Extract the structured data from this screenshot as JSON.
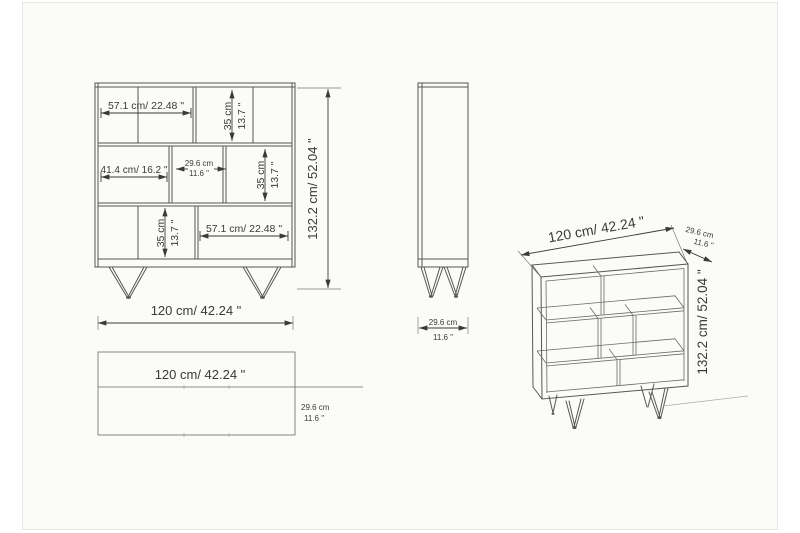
{
  "image": {
    "type": "furniture-technical-drawing",
    "colors": {
      "line": "#565656",
      "text": "#3a3a3a",
      "canvas": "#fbfbf8",
      "canvas_border": "#e8e8e2"
    }
  },
  "front_view": {
    "top": {
      "width": "57.1 cm/ 22.48 \"",
      "height_cm": "35 cm",
      "height_in": "13.7 \""
    },
    "middle": {
      "left_width": "41.4 cm/ 16.2 \"",
      "center_width_cm": "29.6 cm",
      "center_width_in": "11.6 \"",
      "height_cm": "35 cm",
      "height_in": "13.7 \""
    },
    "bottom": {
      "height_cm": "35 cm",
      "height_in": "13.7 \"",
      "width": "57.1 cm/ 22.48 \""
    },
    "overall": {
      "width": "120 cm/ 42.24 \"",
      "height": "132.2 cm/ 52.04 \""
    }
  },
  "side_view": {
    "depth_cm": "29.6 cm",
    "depth_in": "11.6 \""
  },
  "top_view": {
    "width": "120 cm/ 42.24 \"",
    "depth_cm": "29.6 cm",
    "depth_in": "11.6 \""
  },
  "perspective_view": {
    "width": "120 cm/ 42.24 \"",
    "depth_cm": "29.6 cm",
    "depth_in": "11.6 \"",
    "height": "132.2 cm/ 52.04 \""
  }
}
